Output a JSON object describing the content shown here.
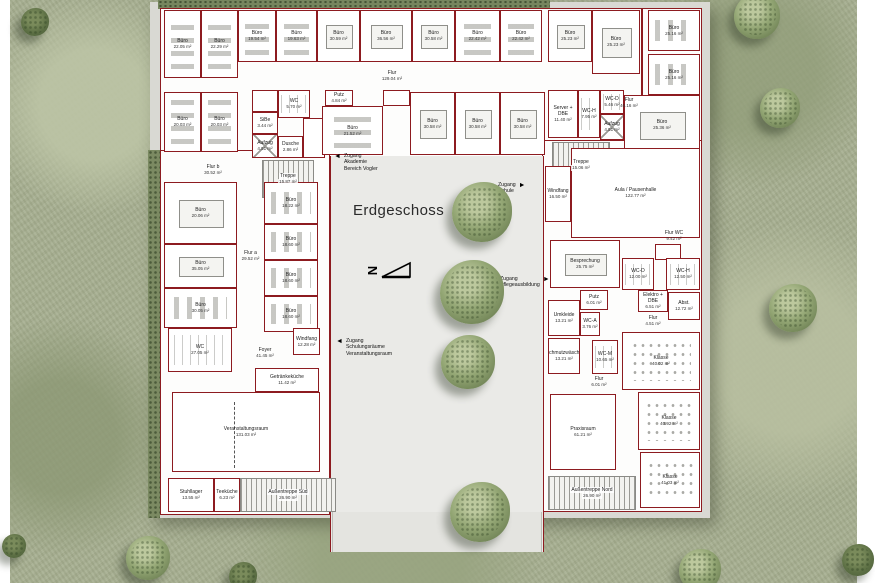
{
  "title": {
    "text": "Erdgeschoss"
  },
  "colors": {
    "wall": "#8d1b20",
    "grass": "#a6ae90",
    "courtyard": "#eaeae7",
    "tree": "#93a674",
    "paper": "#ffffff"
  },
  "north_arrow": {
    "label": "N"
  },
  "annotations": [
    {
      "id": "zugang-akademie",
      "lines": [
        "Zugang",
        "Akademie",
        "Bereich Vogler"
      ],
      "arrow": "left",
      "x": 334,
      "y": 153
    },
    {
      "id": "zugang-schule",
      "lines": [
        "Zugang",
        "Schule"
      ],
      "arrow": "right",
      "x": 498,
      "y": 182
    },
    {
      "id": "zugang-pflege",
      "lines": [
        "Zugang",
        "Pflegeausbildung"
      ],
      "arrow": "right",
      "x": 500,
      "y": 276
    },
    {
      "id": "zugang-schulung",
      "lines": [
        "Zugang",
        "Schulungsräume",
        "Veranstaltungsraum"
      ],
      "arrow": "left",
      "x": 336,
      "y": 338
    }
  ],
  "rooms": [
    {
      "label": "Büro",
      "area": "22.05 m²",
      "x": 164,
      "y": 10,
      "w": 37,
      "h": 68,
      "furn": "desks-v"
    },
    {
      "label": "Büro",
      "area": "22.29 m²",
      "x": 201,
      "y": 10,
      "w": 37,
      "h": 68,
      "furn": "desks-v"
    },
    {
      "label": "Büro",
      "area": "19.54 m²",
      "x": 238,
      "y": 10,
      "w": 38,
      "h": 52,
      "furn": "desks-v"
    },
    {
      "label": "Büro",
      "area": "19.63 m²",
      "x": 276,
      "y": 10,
      "w": 41,
      "h": 52,
      "furn": "desks-v"
    },
    {
      "label": "Büro",
      "area": "30.59 m²",
      "x": 317,
      "y": 10,
      "w": 43,
      "h": 52,
      "furn": "table"
    },
    {
      "label": "Büro",
      "area": "36.56 m²",
      "x": 360,
      "y": 10,
      "w": 52,
      "h": 52,
      "furn": "table"
    },
    {
      "label": "Büro",
      "area": "30.58 m²",
      "x": 412,
      "y": 10,
      "w": 43,
      "h": 52,
      "furn": "table"
    },
    {
      "label": "Büro",
      "area": "22.42 m²",
      "x": 455,
      "y": 10,
      "w": 45,
      "h": 52,
      "furn": "desks-v"
    },
    {
      "label": "Büro",
      "area": "22.42 m²",
      "x": 500,
      "y": 10,
      "w": 42,
      "h": 52,
      "furn": "desks-v"
    },
    {
      "label": "Büro",
      "area": "25.23 m²",
      "x": 548,
      "y": 10,
      "w": 44,
      "h": 52,
      "furn": "table"
    },
    {
      "label": "Büro",
      "area": "25.23 m²",
      "x": 592,
      "y": 10,
      "w": 48,
      "h": 64,
      "furn": "table"
    },
    {
      "label": "Büro",
      "area": "25.16 m²",
      "x": 648,
      "y": 10,
      "w": 52,
      "h": 41,
      "furn": "desks-h"
    },
    {
      "label": "Büro",
      "area": "25.16 m²",
      "x": 648,
      "y": 54,
      "w": 52,
      "h": 41,
      "furn": "desks-h"
    },
    {
      "label": "Flur",
      "area": "129.04 m²",
      "x": 238,
      "y": 62,
      "w": 308,
      "h": 28,
      "type": "corridor"
    },
    {
      "label": "Flur",
      "area": "40.16 m²",
      "x": 612,
      "y": 62,
      "w": 34,
      "h": 82,
      "type": "corridor"
    },
    {
      "label": "Büro",
      "area": "20.03 m²",
      "x": 164,
      "y": 92,
      "w": 37,
      "h": 60,
      "furn": "desks-v"
    },
    {
      "label": "Büro",
      "area": "20.03 m²",
      "x": 201,
      "y": 92,
      "w": 37,
      "h": 60,
      "furn": "desks-v"
    },
    {
      "label": "",
      "area": "",
      "x": 252,
      "y": 90,
      "w": 26,
      "h": 22
    },
    {
      "label": "WC",
      "area": "5.70 m²",
      "x": 278,
      "y": 90,
      "w": 32,
      "h": 28,
      "furn": "stalls"
    },
    {
      "label": "SiBe",
      "area": "3.44 m²",
      "x": 252,
      "y": 112,
      "w": 26,
      "h": 22
    },
    {
      "label": "Aufzug",
      "area": "4.51 m²",
      "x": 252,
      "y": 134,
      "w": 26,
      "h": 24,
      "type": "lift"
    },
    {
      "label": "Dusche",
      "area": "2.86 m²",
      "x": 278,
      "y": 136,
      "w": 25,
      "h": 22
    },
    {
      "label": "",
      "area": "",
      "x": 303,
      "y": 118,
      "w": 22,
      "h": 40
    },
    {
      "label": "Putz",
      "area": "4.84 m²",
      "x": 325,
      "y": 90,
      "w": 28,
      "h": 16
    },
    {
      "label": "Büro",
      "area": "21.52 m²",
      "x": 322,
      "y": 106,
      "w": 61,
      "h": 49,
      "furn": "desks-v"
    },
    {
      "label": "",
      "area": "",
      "x": 383,
      "y": 90,
      "w": 27,
      "h": 16
    },
    {
      "label": "Büro",
      "area": "30.58 m²",
      "x": 410,
      "y": 92,
      "w": 45,
      "h": 63,
      "furn": "table"
    },
    {
      "label": "Büro",
      "area": "30.58 m²",
      "x": 455,
      "y": 92,
      "w": 45,
      "h": 63,
      "furn": "table"
    },
    {
      "label": "Büro",
      "area": "30.58 m²",
      "x": 500,
      "y": 92,
      "w": 45,
      "h": 63,
      "furn": "table"
    },
    {
      "label": "Server + DBE",
      "area": "11.40 m²",
      "x": 548,
      "y": 90,
      "w": 30,
      "h": 48
    },
    {
      "label": "WC-H",
      "area": "7.95 m²",
      "x": 578,
      "y": 90,
      "w": 22,
      "h": 48,
      "furn": "stalls"
    },
    {
      "label": "WC-D",
      "area": "5.46 m²",
      "x": 600,
      "y": 90,
      "w": 24,
      "h": 24,
      "furn": "stalls"
    },
    {
      "label": "Aufzug",
      "area": "4.51 m²",
      "x": 600,
      "y": 114,
      "w": 24,
      "h": 26,
      "type": "lift"
    },
    {
      "label": "Büro",
      "area": "25.36 m²",
      "x": 624,
      "y": 95,
      "w": 76,
      "h": 60,
      "furn": "table"
    },
    {
      "label": "Treppe",
      "area": "15.06 m²",
      "x": 552,
      "y": 142,
      "w": 58,
      "h": 46,
      "type": "stairs"
    },
    {
      "label": "Flur b",
      "area": "30.52 m²",
      "x": 164,
      "y": 158,
      "w": 98,
      "h": 24,
      "type": "corridor"
    },
    {
      "label": "Treppe",
      "area": "15.87 m²",
      "x": 262,
      "y": 160,
      "w": 52,
      "h": 38,
      "type": "stairs"
    },
    {
      "label": "Büro",
      "area": "20.06 m²",
      "x": 164,
      "y": 182,
      "w": 73,
      "h": 62,
      "furn": "table"
    },
    {
      "label": "Flur a",
      "area": "29.52 m²",
      "x": 237,
      "y": 182,
      "w": 27,
      "h": 148,
      "type": "corridor"
    },
    {
      "label": "Büro",
      "area": "18.22 m²",
      "x": 264,
      "y": 182,
      "w": 54,
      "h": 42,
      "furn": "desks-h"
    },
    {
      "label": "Büro",
      "area": "18.60 m²",
      "x": 264,
      "y": 224,
      "w": 54,
      "h": 36,
      "furn": "desks-h"
    },
    {
      "label": "Büro",
      "area": "18.60 m²",
      "x": 264,
      "y": 260,
      "w": 54,
      "h": 36,
      "furn": "desks-h"
    },
    {
      "label": "Büro",
      "area": "18.60 m²",
      "x": 264,
      "y": 296,
      "w": 54,
      "h": 36,
      "furn": "desks-h"
    },
    {
      "label": "Büro",
      "area": "35.05 m²",
      "x": 164,
      "y": 244,
      "w": 73,
      "h": 44,
      "furn": "table"
    },
    {
      "label": "Büro",
      "area": "30.05 m²",
      "x": 164,
      "y": 288,
      "w": 73,
      "h": 40,
      "furn": "desks-h"
    },
    {
      "label": "WC",
      "area": "27.05 m²",
      "x": 168,
      "y": 328,
      "w": 64,
      "h": 44,
      "furn": "stalls"
    },
    {
      "label": "Foyer",
      "area": "41.45 m²",
      "x": 237,
      "y": 330,
      "w": 56,
      "h": 46,
      "type": "corridor"
    },
    {
      "label": "Windfang",
      "area": "12.28 m²",
      "x": 293,
      "y": 328,
      "w": 27,
      "h": 27
    },
    {
      "label": "Getränkeküche",
      "area": "11.42 m²",
      "x": 255,
      "y": 368,
      "w": 64,
      "h": 24
    },
    {
      "label": "Veranstaltungsraum",
      "area": "131.03 m²",
      "x": 172,
      "y": 392,
      "w": 148,
      "h": 80,
      "type": "hall"
    },
    {
      "label": "Stuhllager",
      "area": "13.55 m²",
      "x": 168,
      "y": 478,
      "w": 46,
      "h": 34
    },
    {
      "label": "Teeküche",
      "area": "6.23 m²",
      "x": 214,
      "y": 478,
      "w": 26,
      "h": 34
    },
    {
      "label": "Außentreppe Süd",
      "area": "26.90 m²",
      "x": 240,
      "y": 478,
      "w": 96,
      "h": 34,
      "type": "stairs"
    },
    {
      "label": "Windfang",
      "area": "16.50 m²",
      "x": 545,
      "y": 166,
      "w": 26,
      "h": 56
    },
    {
      "label": "Aula / Pausenhalle",
      "area": "122.77 m²",
      "x": 571,
      "y": 148,
      "w": 129,
      "h": 90,
      "type": "hall"
    },
    {
      "label": "Besprechung",
      "area": "25.75 m²",
      "x": 550,
      "y": 240,
      "w": 70,
      "h": 48,
      "furn": "table"
    },
    {
      "label": "Flur WC",
      "area": "9.42 m²",
      "x": 648,
      "y": 228,
      "w": 52,
      "h": 16,
      "type": "corridor"
    },
    {
      "label": "",
      "area": "",
      "x": 655,
      "y": 244,
      "w": 26,
      "h": 16
    },
    {
      "label": "WC-D",
      "area": "12.00 m²",
      "x": 622,
      "y": 258,
      "w": 32,
      "h": 32,
      "furn": "stalls"
    },
    {
      "label": "WC-H",
      "area": "12.50 m²",
      "x": 666,
      "y": 258,
      "w": 34,
      "h": 32,
      "furn": "stalls"
    },
    {
      "label": "Elektro + DBE",
      "area": "6.51 m²",
      "x": 638,
      "y": 290,
      "w": 30,
      "h": 22
    },
    {
      "label": "Abst.",
      "area": "12.72 m²",
      "x": 668,
      "y": 292,
      "w": 32,
      "h": 28
    },
    {
      "label": "Flur",
      "area": "4.51 m²",
      "x": 638,
      "y": 312,
      "w": 30,
      "h": 18,
      "type": "corridor"
    },
    {
      "label": "Putz",
      "area": "6.01 m²",
      "x": 580,
      "y": 290,
      "w": 28,
      "h": 20
    },
    {
      "label": "Umkleide",
      "area": "13.21 m²",
      "x": 548,
      "y": 300,
      "w": 32,
      "h": 36
    },
    {
      "label": "WC-A",
      "area": "3.76 m²",
      "x": 580,
      "y": 312,
      "w": 20,
      "h": 24
    },
    {
      "label": "WC-M",
      "area": "10.65 m²",
      "x": 592,
      "y": 340,
      "w": 26,
      "h": 34,
      "furn": "stalls"
    },
    {
      "label": "Schmutzwäsche",
      "area": "13.21 m²",
      "x": 548,
      "y": 338,
      "w": 32,
      "h": 36
    },
    {
      "label": "Flur",
      "area": "6.01 m²",
      "x": 580,
      "y": 374,
      "w": 38,
      "h": 16,
      "type": "corridor"
    },
    {
      "label": "Klasse",
      "area": "40.02 m²",
      "x": 622,
      "y": 332,
      "w": 78,
      "h": 58,
      "furn": "chairs"
    },
    {
      "label": "Klasse",
      "area": "40.92 m²",
      "x": 638,
      "y": 392,
      "w": 62,
      "h": 58,
      "furn": "chairs"
    },
    {
      "label": "Klasse",
      "area": "41.03 m²",
      "x": 640,
      "y": 452,
      "w": 60,
      "h": 56,
      "furn": "chairs"
    },
    {
      "label": "Praxisraum",
      "area": "61.21 m²",
      "x": 550,
      "y": 394,
      "w": 66,
      "h": 76,
      "type": "hall"
    },
    {
      "label": "Außentreppe Nord",
      "area": "26.90 m²",
      "x": 548,
      "y": 476,
      "w": 88,
      "h": 34,
      "type": "stairs"
    }
  ],
  "trees": [
    {
      "x": 482,
      "y": 212,
      "r": 30
    },
    {
      "x": 472,
      "y": 292,
      "r": 32
    },
    {
      "x": 468,
      "y": 362,
      "r": 27
    },
    {
      "x": 480,
      "y": 512,
      "r": 30
    },
    {
      "x": 757,
      "y": 16,
      "r": 23
    },
    {
      "x": 780,
      "y": 108,
      "r": 20
    },
    {
      "x": 793,
      "y": 308,
      "r": 24
    },
    {
      "x": 700,
      "y": 570,
      "r": 21
    },
    {
      "x": 148,
      "y": 558,
      "r": 22
    },
    {
      "x": 35,
      "y": 22,
      "r": 14,
      "variant": "dark"
    },
    {
      "x": 14,
      "y": 546,
      "r": 12,
      "variant": "dark"
    },
    {
      "x": 243,
      "y": 576,
      "r": 14,
      "variant": "dark"
    },
    {
      "x": 858,
      "y": 560,
      "r": 16,
      "variant": "dark"
    }
  ]
}
